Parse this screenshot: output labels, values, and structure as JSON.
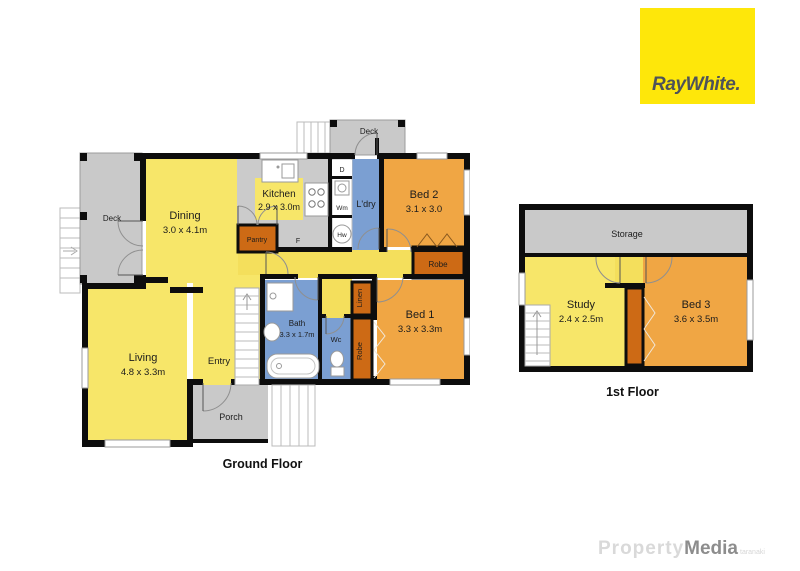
{
  "logo": {
    "text": "RayWhite."
  },
  "watermark": {
    "part1": "Property",
    "part2": "Media",
    "part3": "taranaki"
  },
  "ground_floor": {
    "caption": "Ground Floor",
    "rooms": {
      "deck_left": {
        "name": "Deck"
      },
      "deck_top": {
        "name": "Deck"
      },
      "dining": {
        "name": "Dining",
        "dims": "3.0 x 4.1m"
      },
      "kitchen": {
        "name": "Kitchen",
        "dims": "2.9 x 3.0m"
      },
      "pantry": {
        "name": "Pantry"
      },
      "fridge": {
        "name": "F"
      },
      "dishwasher": {
        "name": "D"
      },
      "washing_machine": {
        "name": "Wm"
      },
      "hot_water": {
        "name": "Hw"
      },
      "laundry": {
        "name": "L'dry"
      },
      "bed2": {
        "name": "Bed 2",
        "dims": "3.1 x 3.0"
      },
      "robe_bed2": {
        "name": "Robe"
      },
      "bed1": {
        "name": "Bed 1",
        "dims": "3.3 x 3.3m"
      },
      "linen": {
        "name": "Linen"
      },
      "robe_bed1": {
        "name": "Robe"
      },
      "wc": {
        "name": "Wc"
      },
      "bath": {
        "name": "Bath",
        "dims": "3.3 x 1.7m"
      },
      "entry": {
        "name": "Entry"
      },
      "living": {
        "name": "Living",
        "dims": "4.8 x 3.3m"
      },
      "porch": {
        "name": "Porch"
      }
    }
  },
  "first_floor": {
    "caption": "1st Floor",
    "rooms": {
      "storage": {
        "name": "Storage"
      },
      "study": {
        "name": "Study",
        "dims": "2.4 x 2.5m"
      },
      "bed3": {
        "name": "Bed 3",
        "dims": "3.6 x 3.5m"
      }
    }
  },
  "colors": {
    "room_yellow": "#f7e669",
    "bedroom_orange": "#f0a644",
    "robe_dark_orange": "#cd6a15",
    "wet_area_blue": "#7b9fd2",
    "deck_gray": "#c9c9c9",
    "wall_black": "#0d0d0d",
    "brand_yellow": "#fee70a"
  }
}
